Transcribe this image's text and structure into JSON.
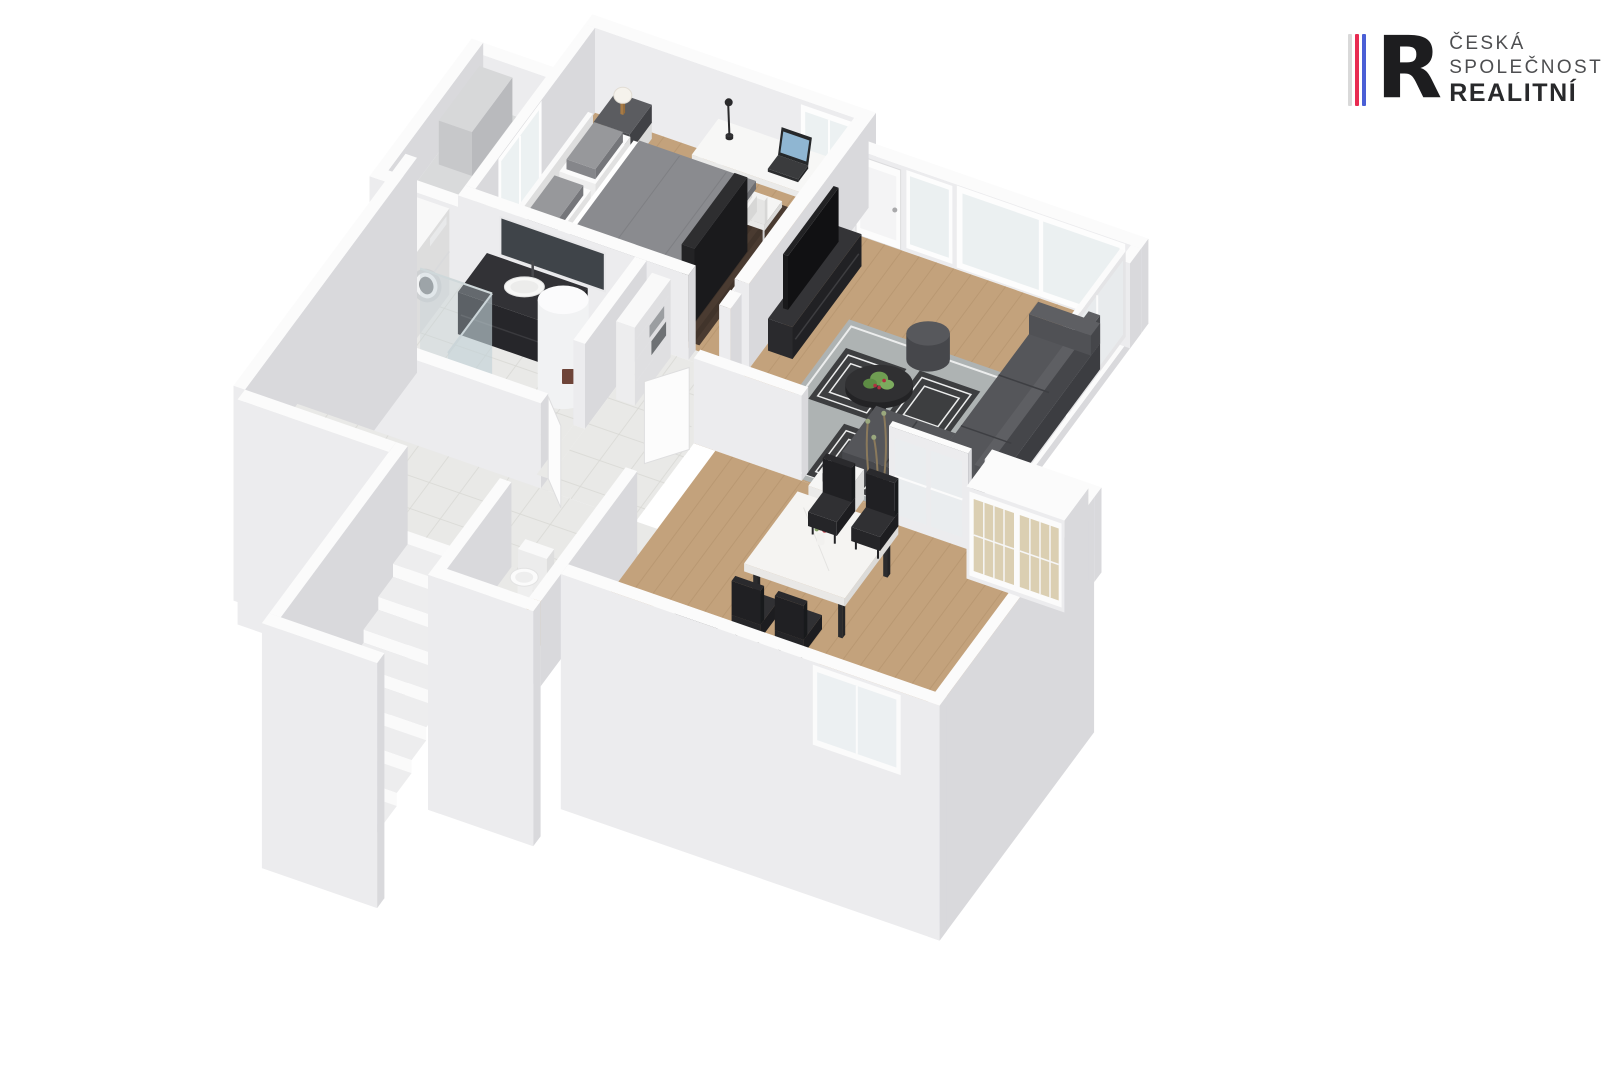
{
  "page": {
    "background": "#ffffff",
    "content_type": "3D isometric apartment floor plan rendering"
  },
  "logo": {
    "monogram": "R",
    "line1": "ČESKÁ",
    "line2": "SPOLEČNOST",
    "line3": "REALITNÍ",
    "stripe_colors": [
      "#d9d9d9",
      "#e82b51",
      "#4a5fd6"
    ],
    "monogram_color": "#1d1d1f",
    "text_color": "#4d4e50",
    "text_bold_color": "#28292b"
  },
  "floorplan": {
    "colors": {
      "wall_top": "#fbfbfb",
      "wall_face": "#ececee",
      "wall_side": "#d9d9dc",
      "wood": "#c3a27c",
      "wood_line": "#ad8c66",
      "tile": "#e9e9e7",
      "tile_line": "#d9d9d5",
      "balcony_floor": "#d9dadb",
      "balcony_unit": "#d7d8d9",
      "rug_a": "#4a3b31",
      "rug_b": "#41342b",
      "rug_gray": "#aeb3b3",
      "rug_dark": "#3d3e40",
      "rug_white": "#eceded",
      "duvet": "#8a8b8f",
      "sofa": "#55565a",
      "furn_black": "#2c2c2e",
      "marble": "#f5f4f2",
      "chair": "#2b2b2d",
      "glass": "#e9eef0",
      "shower_glass": "#c3d2d8",
      "cabinet_glass": "#d9ccae",
      "wood_furn": "#b58a4c",
      "plant": "#6f9e52",
      "flower": "#b03040",
      "mat": "#9aa0a2"
    },
    "rooms": [
      {
        "id": "bedroom",
        "furniture": [
          "double bed",
          "two nightstands",
          "two table lamps",
          "desk with laptop",
          "desk lamp",
          "desk chair",
          "TV panel",
          "dark brown rug",
          "balcony door"
        ]
      },
      {
        "id": "balcony",
        "furniture": [
          "storage unit",
          "railing walls"
        ]
      },
      {
        "id": "bathroom",
        "furniture": [
          "black vanity with sink",
          "mirror",
          "water heater cylinder",
          "walk-in shower with glass screen",
          "bath mat",
          "stacked washer and dryer",
          "towel shelf"
        ]
      },
      {
        "id": "hallway",
        "furniture": [
          "staircase down",
          "open white doors",
          "tiled floor"
        ]
      },
      {
        "id": "wc",
        "furniture": [
          "toilet",
          "wooden bench"
        ]
      },
      {
        "id": "living-room",
        "furniture": [
          "corner sofa",
          "pouf",
          "round coffee table with plant",
          "patterned gray rug",
          "TV with black media console",
          "floor-to-ceiling windows",
          "glass door unit"
        ]
      },
      {
        "id": "dining-room",
        "furniture": [
          "marble dining table",
          "four black chairs",
          "vase with flowers",
          "glass display cabinet",
          "kitchen counter",
          "decorative branches",
          "window"
        ]
      }
    ]
  }
}
